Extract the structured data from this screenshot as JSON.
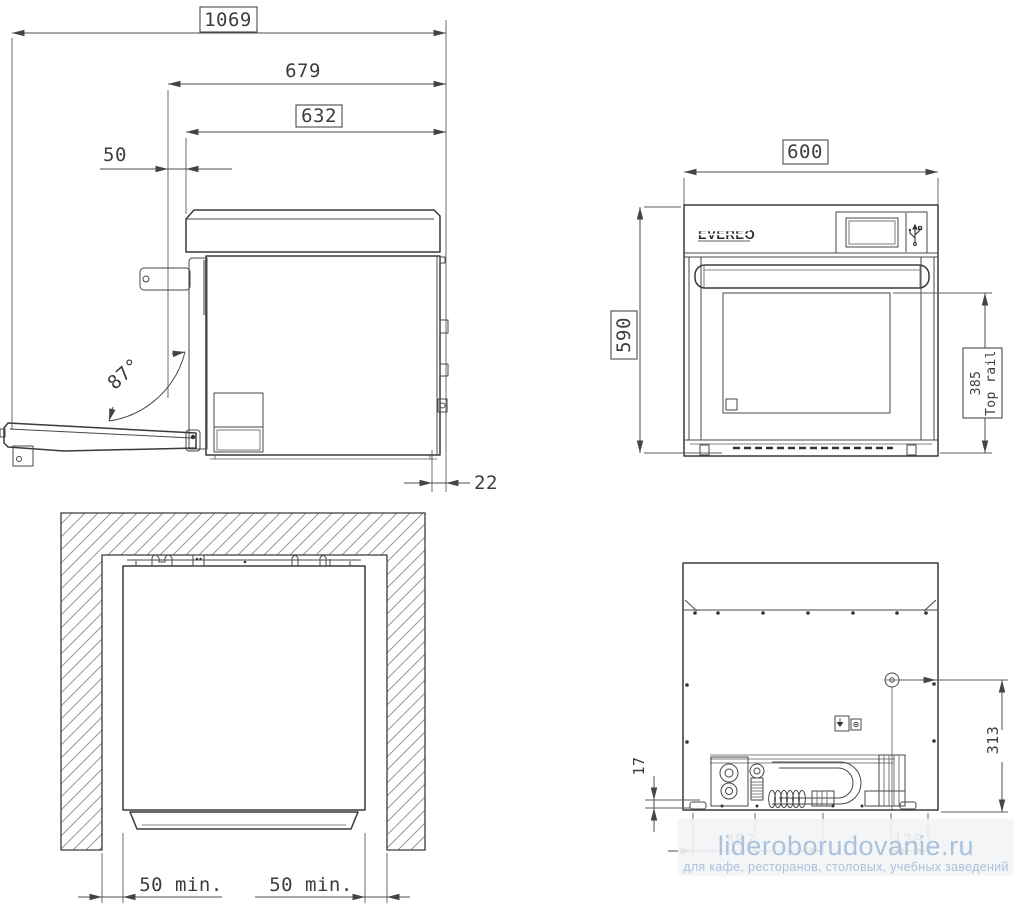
{
  "side_view": {
    "dims": {
      "overall_depth_door_open": "1069",
      "depth_to_hinge": "679",
      "body_depth": "632",
      "front_offset": "50",
      "door_opening_angle": "87°",
      "rear_clearance": "22"
    }
  },
  "front_view": {
    "brand": "EVEREO",
    "dims": {
      "width": "600",
      "height": "590",
      "top_rail_value": "385",
      "top_rail_label": "Top rail"
    }
  },
  "installation_view": {
    "dims": {
      "left_clearance": "50 min.",
      "right_clearance": "50 min."
    }
  },
  "rear_view": {
    "dims": {
      "bottom_offset": "17",
      "connection_height": "313",
      "obscured_left": "382",
      "obscured_right": "120"
    }
  },
  "watermark": {
    "site": "lideroborudovanie.ru",
    "tagline": "для кафе, ресторанов, столовых, учебных заведений"
  }
}
